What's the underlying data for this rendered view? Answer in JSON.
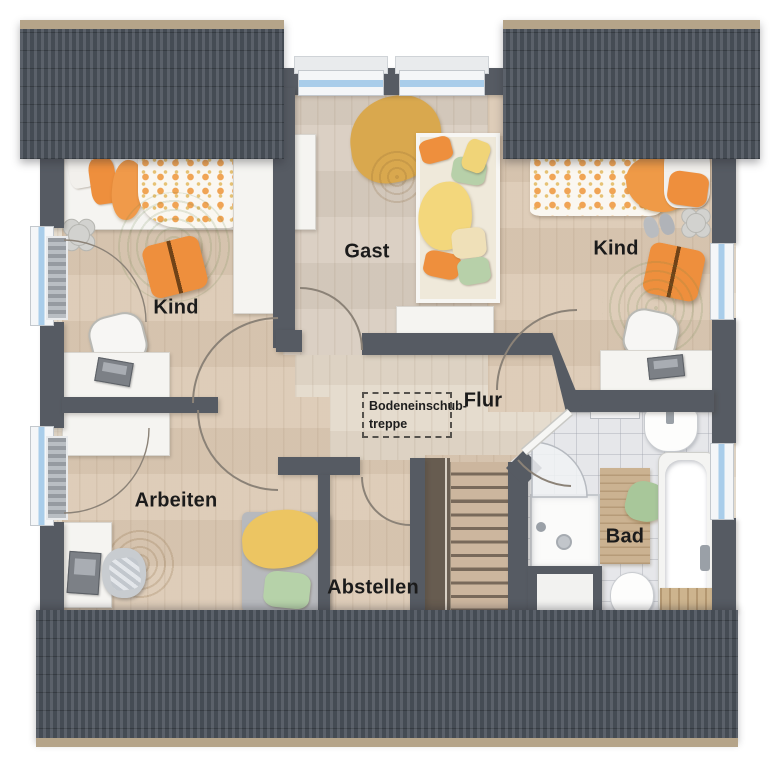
{
  "rooms": [
    {
      "id": "kind-left",
      "label": "Kind"
    },
    {
      "id": "gast",
      "label": "Gast"
    },
    {
      "id": "kind-right",
      "label": "Kind"
    },
    {
      "id": "flur",
      "label": "Flur"
    },
    {
      "id": "arbeiten",
      "label": "Arbeiten"
    },
    {
      "id": "abstellen",
      "label": "Abstellen"
    },
    {
      "id": "bad",
      "label": "Bad"
    }
  ],
  "annotations": {
    "attic_hatch_line1": "Bodeneinschub-",
    "attic_hatch_line2": "treppe"
  },
  "colors": {
    "wall": "#565b63",
    "roof": "#4d545d",
    "roofEdge": "#b5a489",
    "floorRoom": "#dccab5",
    "floorHall": "#e4dacb",
    "floorGast": "#d9cec1",
    "tile": "#e6e7ea",
    "glass": "#a9cdea",
    "rugGreen": "#b9cf9f",
    "orange": "#ee8f3d",
    "mustard": "#d9a84e",
    "wood2": "#ccb69e",
    "arc": "#8b8277"
  }
}
